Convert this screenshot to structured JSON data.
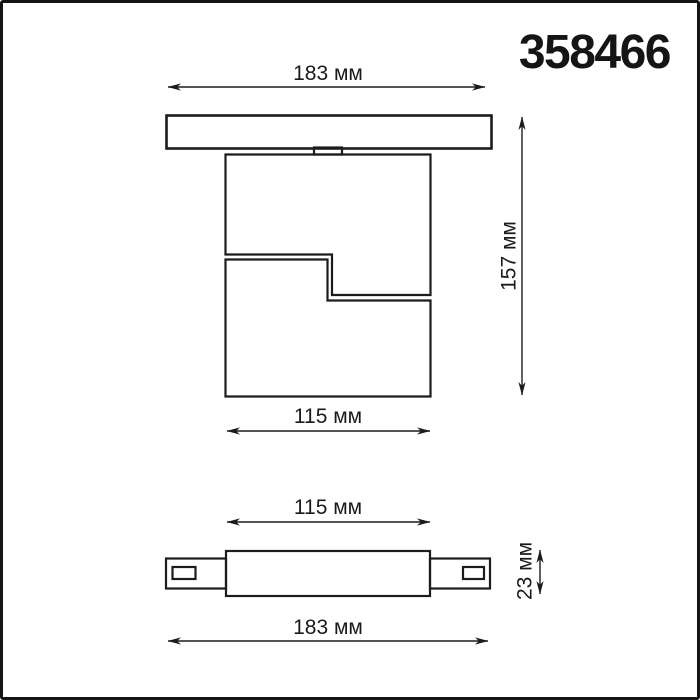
{
  "page": {
    "background_color": "#ffffff",
    "border_color": "#141414"
  },
  "header": {
    "model_number": "358466"
  },
  "front_view": {
    "dim_track_width": "183 мм",
    "dim_total_height": "157 мм",
    "dim_body_width": "115 мм"
  },
  "top_view": {
    "dim_body_width": "115 мм",
    "dim_body_depth": "23 мм",
    "dim_track_width": "183 мм"
  },
  "colors": {
    "line": "#1c1c1c",
    "text": "#1a1a1a"
  },
  "units": "мм"
}
